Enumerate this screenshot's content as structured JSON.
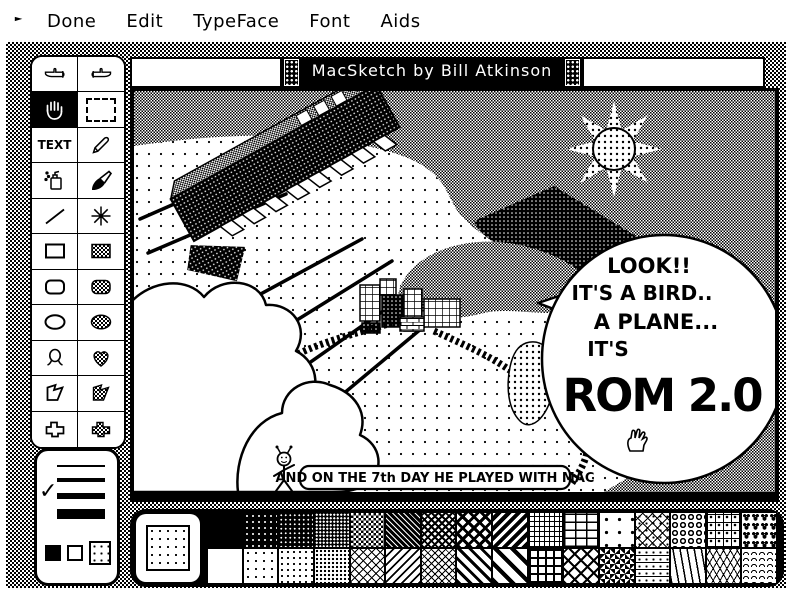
{
  "menu": {
    "items": [
      "Done",
      "Edit",
      "TypeFace",
      "Font",
      "Aids"
    ],
    "flag_icon": "flag-icon"
  },
  "window": {
    "title": "MacSketch by Bill Atkinson"
  },
  "tools": {
    "text_label": "TEXT",
    "selected": "grabber-hand",
    "names": [
      "finger-left",
      "finger-right",
      "grabber-hand",
      "selection-marquee",
      "text",
      "pencil",
      "spray-can",
      "paintbrush",
      "line",
      "star-burst",
      "rectangle",
      "rectangle-filled",
      "rounded-rect",
      "rounded-rect-filled",
      "oval",
      "oval-filled",
      "freeform",
      "heart-filled",
      "polygon",
      "polygon-filled",
      "shape",
      "shape-filled"
    ]
  },
  "line_width_panel": {
    "widths_px": [
      2,
      4,
      6,
      10
    ],
    "selected_index": 2,
    "checkmark": "✓",
    "boxes": [
      "black",
      "white",
      "dotted"
    ]
  },
  "canvas_art": {
    "bubble_lines": [
      "LOOK!!",
      "IT'S A BIRD..",
      "A PLANE...",
      "IT'S",
      "ROM 2.0"
    ],
    "caption": "AND ON THE 7th DAY HE PLAYED WITH MAC",
    "elements": [
      "sun-star",
      "flying-rom-chip",
      "speed-lines",
      "clouds",
      "city-blocks",
      "winding-road",
      "mountains",
      "stick-figure",
      "speech-bubble",
      "fist-hand"
    ]
  },
  "pattern_palette": {
    "current": "dots-sparse",
    "top_row": [
      "black",
      "invdots-sparse",
      "invdots-med",
      "invdots-dense",
      "checker-dark",
      "diag-dark",
      "crosshatch-dark",
      "lattice-dark",
      "stripes-dark",
      "grid-fine",
      "bricks",
      "dot-square",
      "diamond-dots",
      "rings",
      "grid-cross",
      "hearts"
    ],
    "bottom_row": [
      "white",
      "dots-sparse",
      "dots-med",
      "dots-dense",
      "diamond-lattice",
      "diag-lines",
      "crosshatch",
      "diag-thick",
      "diag-wide",
      "grid-panes",
      "basket",
      "zigzag",
      "tri-dots",
      "waves",
      "tri-lattice",
      "scales"
    ]
  },
  "colors": {
    "ink": "#000000",
    "paper": "#ffffff"
  }
}
